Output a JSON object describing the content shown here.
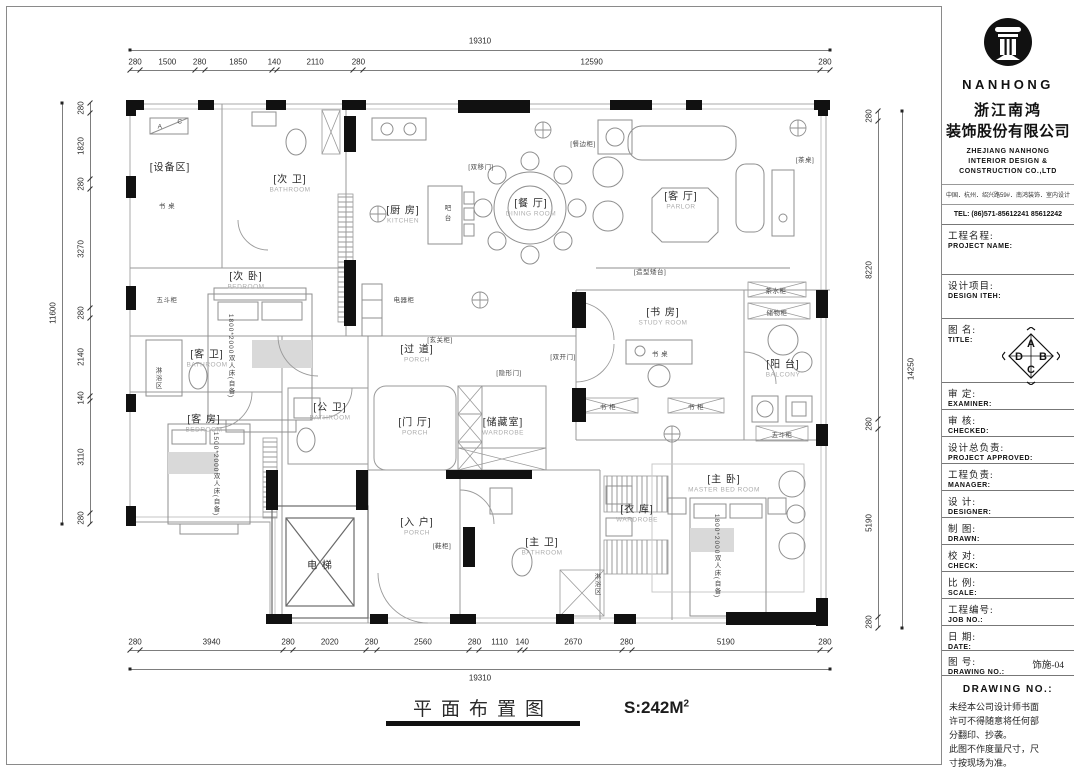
{
  "title_block": {
    "brand": "NANHONG",
    "company_cn_1": "浙江南鸿",
    "company_cn_2": "装饰股份有限公司",
    "company_en": "ZHEJIANG NANHONG INTERIOR DESIGN & CONSTRUCTION CO.,LTD",
    "address": "中国．杭州．绍兴路59#．南鸿装饰．室内设计",
    "tel": "TEL:  (86)571-85612241  85612242",
    "compass_letters": {
      "top": "A",
      "right": "B",
      "bottom": "C",
      "left": "D"
    },
    "fields": [
      {
        "id": "project-name",
        "cn": "工程名程:",
        "en": "PROJECT NAME:",
        "value": "",
        "h": 50
      },
      {
        "id": "design-item",
        "cn": "设计项目:",
        "en": "DESIGN ITEH:",
        "value": "",
        "h": 44
      },
      {
        "id": "title",
        "cn": "图 名:",
        "en": "TITLE:",
        "value": "",
        "h": 64,
        "compass": true
      },
      {
        "id": "examiner",
        "cn": "审 定:",
        "en": "EXAMINER:",
        "value": "",
        "h": 27
      },
      {
        "id": "checked",
        "cn": "审 核:",
        "en": "CHECKED:",
        "value": "",
        "h": 27
      },
      {
        "id": "project-approved",
        "cn": "设计总负责:",
        "en": "PROJECT APPROVED:",
        "value": "",
        "h": 27
      },
      {
        "id": "manager",
        "cn": "工程负责:",
        "en": "MANAGER:",
        "value": "",
        "h": 27
      },
      {
        "id": "designer",
        "cn": "设 计:",
        "en": "DESIGNER:",
        "value": "",
        "h": 27
      },
      {
        "id": "drawn",
        "cn": "制 图:",
        "en": "DRAWN:",
        "value": "",
        "h": 27
      },
      {
        "id": "check",
        "cn": "校 对:",
        "en": "CHECK:",
        "value": "",
        "h": 27
      },
      {
        "id": "scale",
        "cn": "比 例:",
        "en": "SCALE:",
        "value": "",
        "h": 27
      },
      {
        "id": "job-no",
        "cn": "工程编号:",
        "en": "JOB  NO.:",
        "value": "",
        "h": 27
      },
      {
        "id": "date",
        "cn": "日 期:",
        "en": "DATE:",
        "value": "",
        "h": 25
      },
      {
        "id": "drawing-no",
        "cn": "图 号:",
        "en": "DRAWING NO.:",
        "value": "饰施-04",
        "h": 25
      }
    ],
    "notes_heading": "DRAWING NO.:",
    "notes": [
      "未经本公司设计师书面",
      "许可不得随意将任何部",
      "分翻印、抄袭。",
      "此图不作度量尺寸，尺",
      "寸按现场为准。",
      "若有不明之处，应立即",
      "通知设计师。"
    ]
  },
  "plan": {
    "rooms": [
      {
        "id": "equipment-area",
        "cn": "[设备区]",
        "en": "",
        "x": 170,
        "y": 168
      },
      {
        "id": "second-bath",
        "cn": "[次 卫]",
        "en": "BATHROOM",
        "x": 290,
        "y": 184
      },
      {
        "id": "second-bedroom",
        "cn": "[次 卧]",
        "en": "BEDROOM",
        "x": 246,
        "y": 281
      },
      {
        "id": "kitchen",
        "cn": "[厨 房]",
        "en": "KITCHEN",
        "x": 403,
        "y": 215
      },
      {
        "id": "dining-room",
        "cn": "[餐 厅]",
        "en": "DINING ROOM",
        "x": 531,
        "y": 208
      },
      {
        "id": "parlor",
        "cn": "[客 厅]",
        "en": "PARLOR",
        "x": 681,
        "y": 201
      },
      {
        "id": "study-room",
        "cn": "[书 房]",
        "en": "STUDY ROOM",
        "x": 663,
        "y": 317
      },
      {
        "id": "balcony",
        "cn": "[阳 台]",
        "en": "BALCONY",
        "x": 783,
        "y": 369
      },
      {
        "id": "guest-bath",
        "cn": "[客 卫]",
        "en": "BATHROOM",
        "x": 207,
        "y": 359
      },
      {
        "id": "guest-room",
        "cn": "[客 房]",
        "en": "BEDROOM",
        "x": 204,
        "y": 424
      },
      {
        "id": "public-bath",
        "cn": "[公 卫]",
        "en": "BATHROOM",
        "x": 330,
        "y": 412
      },
      {
        "id": "corridor",
        "cn": "[过 道]",
        "en": "PORCH",
        "x": 417,
        "y": 354
      },
      {
        "id": "foyer",
        "cn": "[门 厅]",
        "en": "PORCH",
        "x": 415,
        "y": 427
      },
      {
        "id": "storage-room",
        "cn": "[储藏室]",
        "en": "WARDROBE",
        "x": 503,
        "y": 427
      },
      {
        "id": "elevator",
        "cn": "电  梯",
        "en": "",
        "x": 320,
        "y": 566
      },
      {
        "id": "entry",
        "cn": "[入 户]",
        "en": "PORCH",
        "x": 417,
        "y": 527
      },
      {
        "id": "master-bath",
        "cn": "[主 卫]",
        "en": "BATHROOM",
        "x": 542,
        "y": 547
      },
      {
        "id": "wardrobe",
        "cn": "[衣 库]",
        "en": "WARDROBE",
        "x": 637,
        "y": 514
      },
      {
        "id": "master-bedroom",
        "cn": "[主 卧]",
        "en": "MASTER  BED  ROOM",
        "x": 724,
        "y": 484
      }
    ],
    "annotations": [
      {
        "id": "desk-1",
        "t": "书 桌",
        "x": 167,
        "y": 205
      },
      {
        "id": "chest-1",
        "t": "五斗柜",
        "x": 167,
        "y": 299
      },
      {
        "id": "shower-1",
        "t": "淋浴区",
        "x": 157,
        "y": 378,
        "v": true
      },
      {
        "id": "bar-counter",
        "t": "吧 台",
        "x": 446,
        "y": 213,
        "v": true
      },
      {
        "id": "appliance-cab",
        "t": "电器柜",
        "x": 404,
        "y": 299
      },
      {
        "id": "sliding-door",
        "t": "[双移门]",
        "x": 481,
        "y": 166
      },
      {
        "id": "sideboard",
        "t": "[餐边柜]",
        "x": 583,
        "y": 143
      },
      {
        "id": "tea-table",
        "t": "[茶桌]",
        "x": 805,
        "y": 159
      },
      {
        "id": "feature-ledge",
        "t": "[造型矮台]",
        "x": 650,
        "y": 271
      },
      {
        "id": "tea-cabinet",
        "t": "茶水柜",
        "x": 776,
        "y": 290
      },
      {
        "id": "storage-cab",
        "t": "储物柜",
        "x": 777,
        "y": 312
      },
      {
        "id": "double-door",
        "t": "[双开门]",
        "x": 563,
        "y": 356
      },
      {
        "id": "bookcase-1",
        "t": "书 柜",
        "x": 608,
        "y": 406
      },
      {
        "id": "bookcase-2",
        "t": "书 柜",
        "x": 696,
        "y": 406
      },
      {
        "id": "desk-2",
        "t": "书 桌",
        "x": 660,
        "y": 353
      },
      {
        "id": "chest-2",
        "t": "五斗柜",
        "x": 782,
        "y": 434
      },
      {
        "id": "hidden-door",
        "t": "[隐形门]",
        "x": 509,
        "y": 372
      },
      {
        "id": "hall-cabinet",
        "t": "[玄关柜]",
        "x": 440,
        "y": 339
      },
      {
        "id": "shoe-cabinet",
        "t": "[鞋柜]",
        "x": 442,
        "y": 545
      },
      {
        "id": "shower-2",
        "t": "淋浴区",
        "x": 596,
        "y": 584,
        "v": true
      },
      {
        "id": "bed-spec-1",
        "t": "1800*2000双人床(自备)",
        "x": 230,
        "y": 356,
        "v": true
      },
      {
        "id": "bed-spec-2",
        "t": "1500*2000双人床(自备)",
        "x": 215,
        "y": 474,
        "v": true
      },
      {
        "id": "bed-spec-3",
        "t": "1800*2000双人床(自备)",
        "x": 716,
        "y": 556,
        "v": true
      },
      {
        "id": "detail-a",
        "t": "A",
        "x": 160,
        "y": 127
      },
      {
        "id": "detail-c",
        "t": "C",
        "x": 180,
        "y": 122
      }
    ]
  },
  "dimensions": {
    "top": {
      "total": "19310",
      "segments": [
        "280",
        "1500",
        "280",
        "1850",
        "140",
        "2110",
        "280",
        "12590",
        "280"
      ]
    },
    "bottom": {
      "total": "19310",
      "segments": [
        "280",
        "3940",
        "280",
        "2020",
        "280",
        "2560",
        "280",
        "1110",
        "140",
        "2670",
        "280",
        "5190",
        "280"
      ]
    },
    "left": {
      "total": "11600",
      "segments": [
        "280",
        "1820",
        "280",
        "3270",
        "280",
        "2140",
        "140",
        "3110",
        "280"
      ]
    },
    "right": {
      "total": "14250",
      "segments": [
        "280",
        "8220",
        "280",
        "5190",
        "280"
      ]
    }
  },
  "footer": {
    "title": "平面布置图",
    "area": "S:242M",
    "area_sup": "2"
  }
}
